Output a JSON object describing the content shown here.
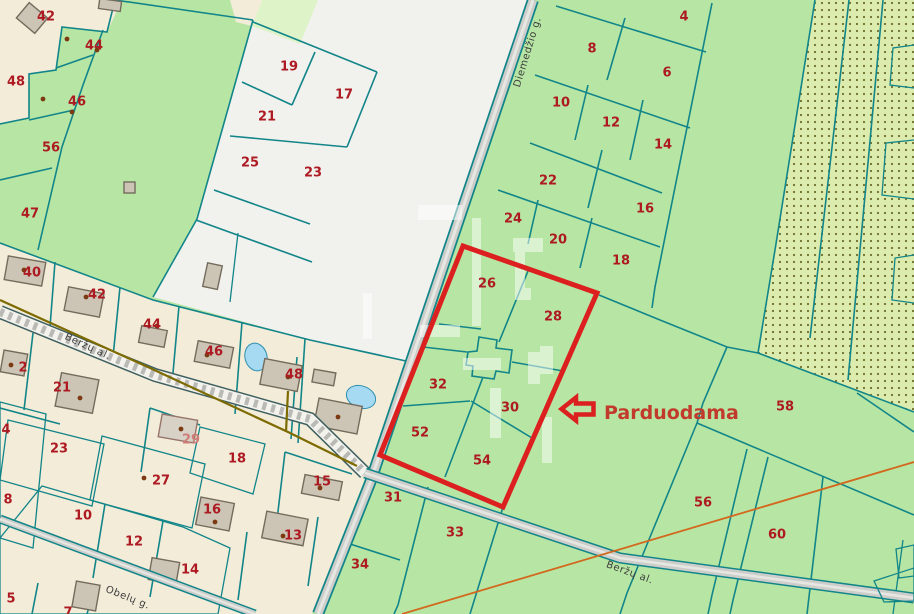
{
  "map": {
    "for_sale_label": "Parduodama",
    "street_labels": [
      {
        "text": "Diemedžio g.",
        "x": 527,
        "y": 52,
        "rot": -73
      },
      {
        "text": "Beržų al.",
        "x": 88,
        "y": 346,
        "rot": 25
      },
      {
        "text": "Beržų al.",
        "x": 630,
        "y": 572,
        "rot": 20
      },
      {
        "text": "Obelų g.",
        "x": 128,
        "y": 597,
        "rot": 22
      }
    ],
    "parcel_labels": [
      {
        "n": "42",
        "x": 46,
        "y": 16
      },
      {
        "n": "44",
        "x": 94,
        "y": 45
      },
      {
        "n": "48",
        "x": 16,
        "y": 81
      },
      {
        "n": "46",
        "x": 77,
        "y": 101
      },
      {
        "n": "56",
        "x": 51,
        "y": 147
      },
      {
        "n": "47",
        "x": 30,
        "y": 213
      },
      {
        "n": "19",
        "x": 289,
        "y": 66
      },
      {
        "n": "17",
        "x": 344,
        "y": 94
      },
      {
        "n": "21",
        "x": 267,
        "y": 116
      },
      {
        "n": "25",
        "x": 250,
        "y": 162
      },
      {
        "n": "23",
        "x": 313,
        "y": 172
      },
      {
        "n": "4",
        "x": 684,
        "y": 16
      },
      {
        "n": "8",
        "x": 592,
        "y": 48
      },
      {
        "n": "6",
        "x": 667,
        "y": 72
      },
      {
        "n": "10",
        "x": 561,
        "y": 102
      },
      {
        "n": "12",
        "x": 611,
        "y": 122
      },
      {
        "n": "14",
        "x": 663,
        "y": 144
      },
      {
        "n": "22",
        "x": 548,
        "y": 180
      },
      {
        "n": "16",
        "x": 645,
        "y": 208
      },
      {
        "n": "24",
        "x": 513,
        "y": 218
      },
      {
        "n": "20",
        "x": 558,
        "y": 239
      },
      {
        "n": "18",
        "x": 621,
        "y": 260
      },
      {
        "n": "26",
        "x": 487,
        "y": 283
      },
      {
        "n": "28",
        "x": 553,
        "y": 316
      },
      {
        "n": "32",
        "x": 438,
        "y": 384
      },
      {
        "n": "30",
        "x": 510,
        "y": 407
      },
      {
        "n": "52",
        "x": 420,
        "y": 432
      },
      {
        "n": "54",
        "x": 482,
        "y": 460
      },
      {
        "n": "58",
        "x": 785,
        "y": 406
      },
      {
        "n": "56",
        "x": 703,
        "y": 502
      },
      {
        "n": "60",
        "x": 777,
        "y": 534
      },
      {
        "n": "31",
        "x": 393,
        "y": 497
      },
      {
        "n": "33",
        "x": 455,
        "y": 532
      },
      {
        "n": "34",
        "x": 360,
        "y": 564
      },
      {
        "n": "40",
        "x": 32,
        "y": 272
      },
      {
        "n": "42",
        "x": 97,
        "y": 294
      },
      {
        "n": "44",
        "x": 152,
        "y": 324
      },
      {
        "n": "46",
        "x": 214,
        "y": 351
      },
      {
        "n": "48",
        "x": 294,
        "y": 374
      },
      {
        "n": "2",
        "x": 23,
        "y": 367
      },
      {
        "n": "21",
        "x": 62,
        "y": 387
      },
      {
        "n": "23",
        "x": 59,
        "y": 448
      },
      {
        "n": "4",
        "x": 6,
        "y": 429
      },
      {
        "n": "29",
        "x": 191,
        "y": 439,
        "muted": true
      },
      {
        "n": "18",
        "x": 237,
        "y": 458
      },
      {
        "n": "27",
        "x": 161,
        "y": 480
      },
      {
        "n": "15",
        "x": 322,
        "y": 481
      },
      {
        "n": "8",
        "x": 8,
        "y": 499
      },
      {
        "n": "16",
        "x": 212,
        "y": 509
      },
      {
        "n": "10",
        "x": 83,
        "y": 515
      },
      {
        "n": "13",
        "x": 293,
        "y": 535
      },
      {
        "n": "12",
        "x": 134,
        "y": 541
      },
      {
        "n": "14",
        "x": 190,
        "y": 569
      },
      {
        "n": "5",
        "x": 11,
        "y": 598
      },
      {
        "n": "7",
        "x": 68,
        "y": 612
      }
    ],
    "colors": {
      "parcel_green": "#b7e6a4",
      "pale_green": "#def3c8",
      "mint_green": "#e4f4df",
      "residential_beige": "#f3ecd9",
      "vacant_white": "#f1f1ee",
      "forest_dotted_bg": "#dcecae",
      "boundary_teal": "#128589",
      "highlight_red": "#dc1f1f",
      "label_red": "#ad1a22",
      "road_gray": "#cdcdca",
      "water_blue": "#a6d9f2",
      "utility_olive": "#7d6b00",
      "survey_orange": "#d2691e",
      "building_gray": "#ccc5b5"
    }
  }
}
